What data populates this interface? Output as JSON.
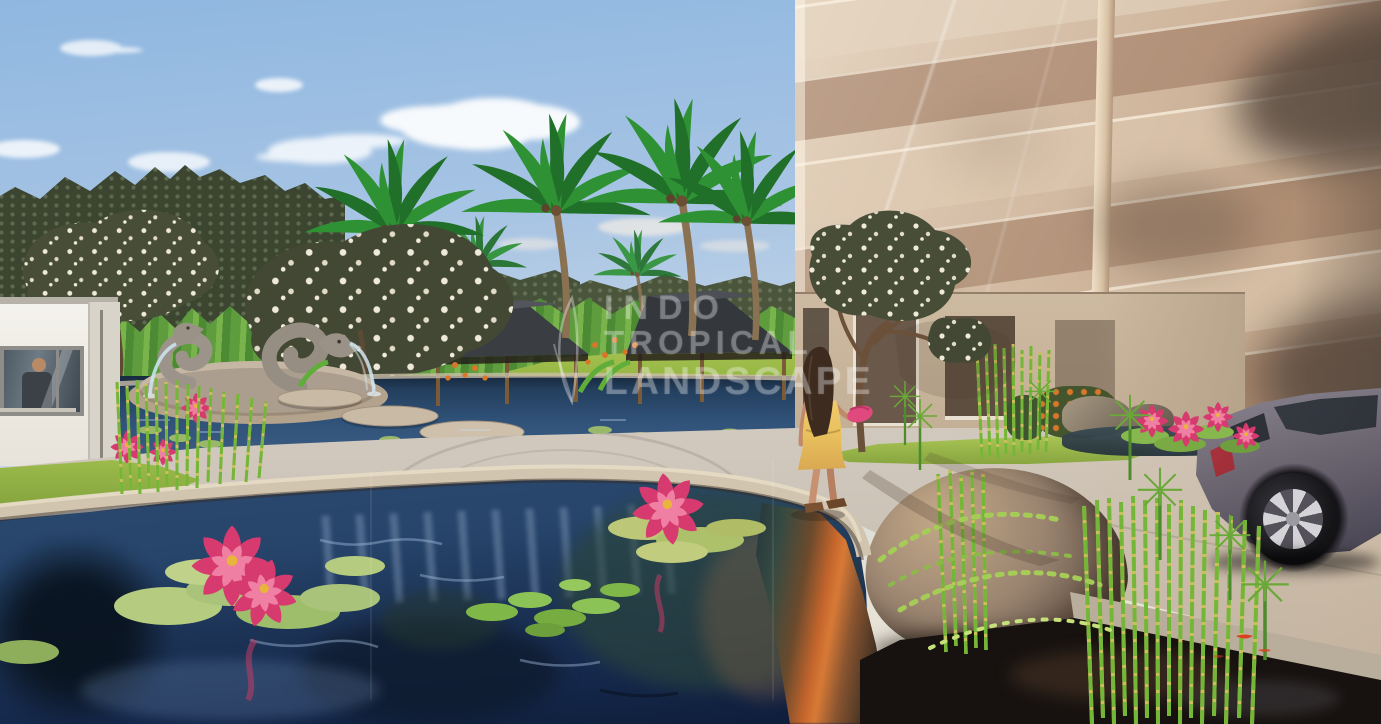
{
  "scene": {
    "watermark": {
      "line1": "INDO",
      "line2": "TROPICAL",
      "line3": "LANDSCAPE"
    }
  },
  "colors": {
    "sky_top": "#8fb7e0",
    "sky_horizon": "#eee6d8",
    "cloud": "#ffffff",
    "far_trees": "#3b4530",
    "banana": "#5f9c3e",
    "palm_green": "#2e9235",
    "palm_dark": "#217029",
    "trunk": "#8a7152",
    "frangipani_leaf": "#474d36",
    "blossom": "#efe9da",
    "roof": "#3a3d42",
    "post": "#7b5a38",
    "guardhouse": "#f4f2ec",
    "glass_light": "#e6d6c2",
    "glass_dark": "#bfa285",
    "glass_shadow": "#54463c",
    "mullion": "#ecd9bf",
    "podium": "#cdbaa1",
    "lawn": "#a3c04f",
    "walkway": "#d0c8bc",
    "pond_deep": "#1c3356",
    "pond_mid": "#2c4a70",
    "pond_highlight": "#a0b9d8",
    "coping": "#d2c5b0",
    "stone": "#9c948a",
    "reed_green": "#74b637",
    "reed_yellow": "#c9c05a",
    "rock_light": "#c2a888",
    "rock_dark": "#5d4c3f",
    "vine": "#a6cc58",
    "lily_pad": "#a9c47a",
    "lotus_pink": "#d63a6e",
    "lotus_light": "#ef7fa3",
    "car_body": "#6e6873",
    "car_glass": "#2b2e35",
    "tail_light": "#8e2531",
    "rim": "#d4d4d8",
    "skin": "#c08a6a",
    "hair": "#3d2b20",
    "dress": "#e9c05c",
    "bag": "#e0497e",
    "water_jet": "#cfe6f2",
    "dark_water": "#171210",
    "koi_orange": "#d8401f",
    "orange_bank": "#c4652c"
  }
}
